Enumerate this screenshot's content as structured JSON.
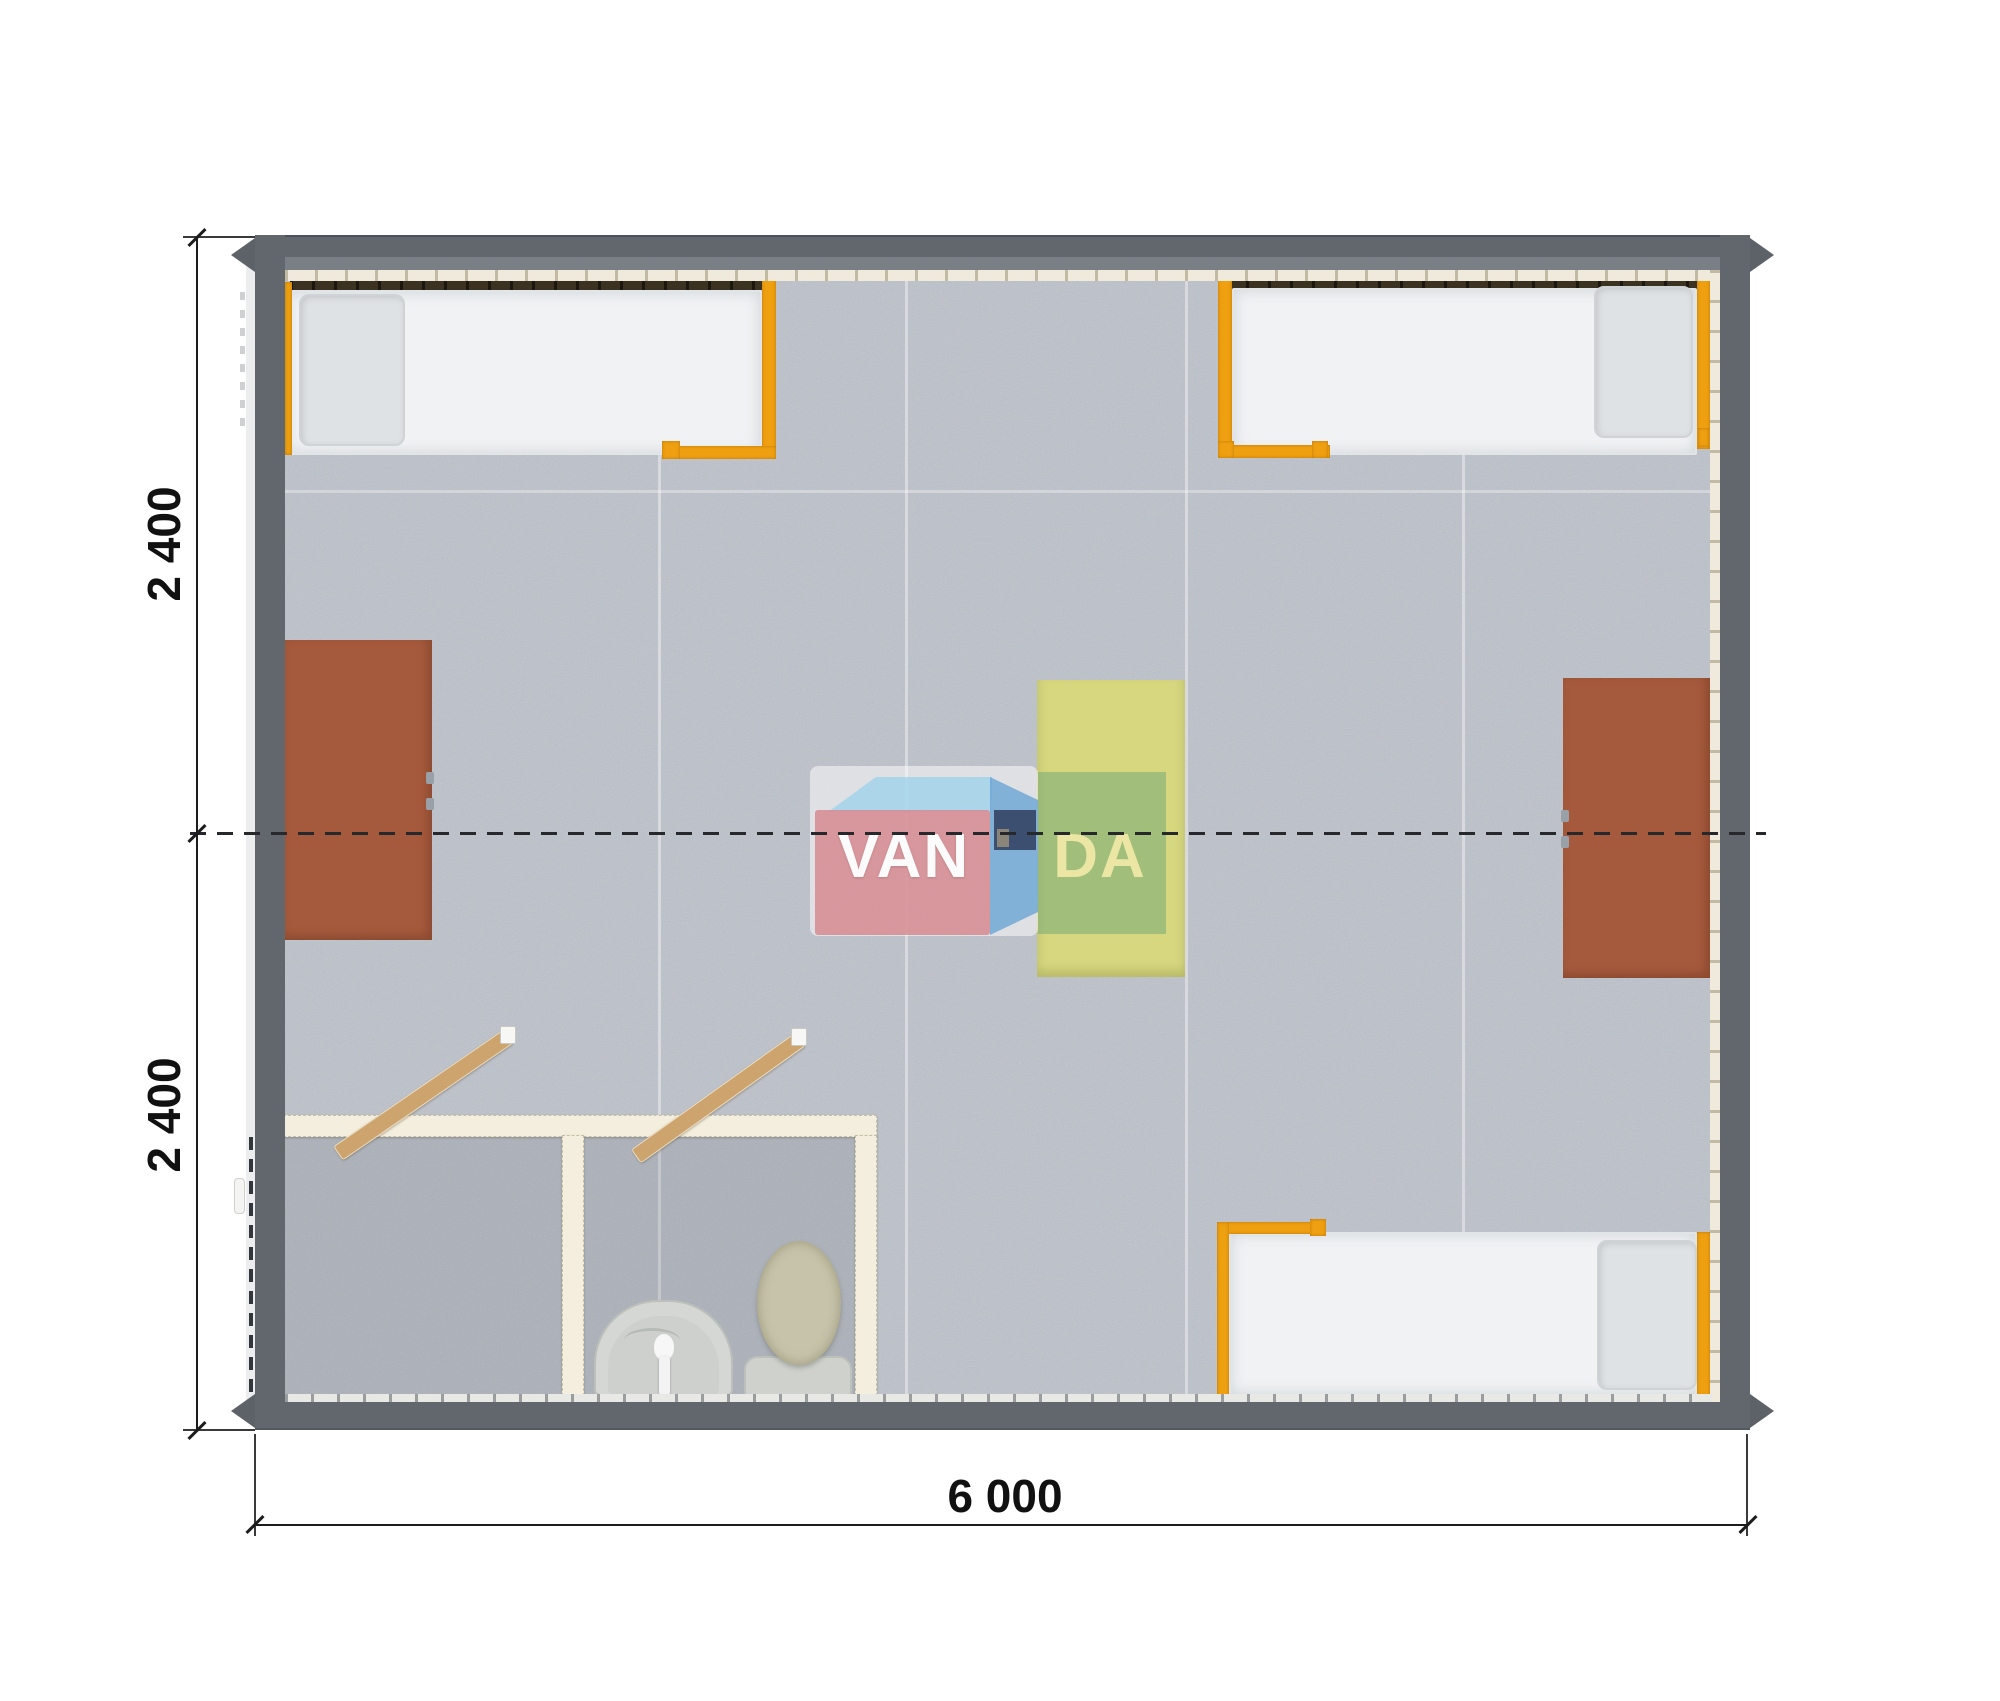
{
  "plan": {
    "view": "top-down floor plan render",
    "module_count_note": "two joined 2400mm modules, 6000mm long"
  },
  "dimensions": {
    "left_top": "2 400",
    "left_bottom": "2 400",
    "bottom": "6 000"
  },
  "watermark": {
    "van": "VAN",
    "da": "DA"
  },
  "elements": {
    "beds": 3,
    "desks": 2,
    "center_table": 1,
    "bathroom": {
      "rooms": 2,
      "fixtures": [
        "washbasin",
        "toilet"
      ],
      "open_doors": 2
    }
  },
  "colors": {
    "wall_gray": "#62676e",
    "floor_gray": "#b9bdc5",
    "accent_orange": "#efa011",
    "bed_white": "#f0f2f4",
    "pillow_gray": "#dfe2e4",
    "desk_brown": "#a65a3d",
    "table_yellow": "#d6d77f",
    "bathroom_wall_cream": "#f3eedd",
    "door_tan": "#cda36e",
    "logo_pink": "#d68a90",
    "logo_blue": "#5e9ed2",
    "logo_navy": "#3d4f71",
    "logo_letter_yellow": "#ebe6a4",
    "annotation_black": "#1c1c1c"
  }
}
